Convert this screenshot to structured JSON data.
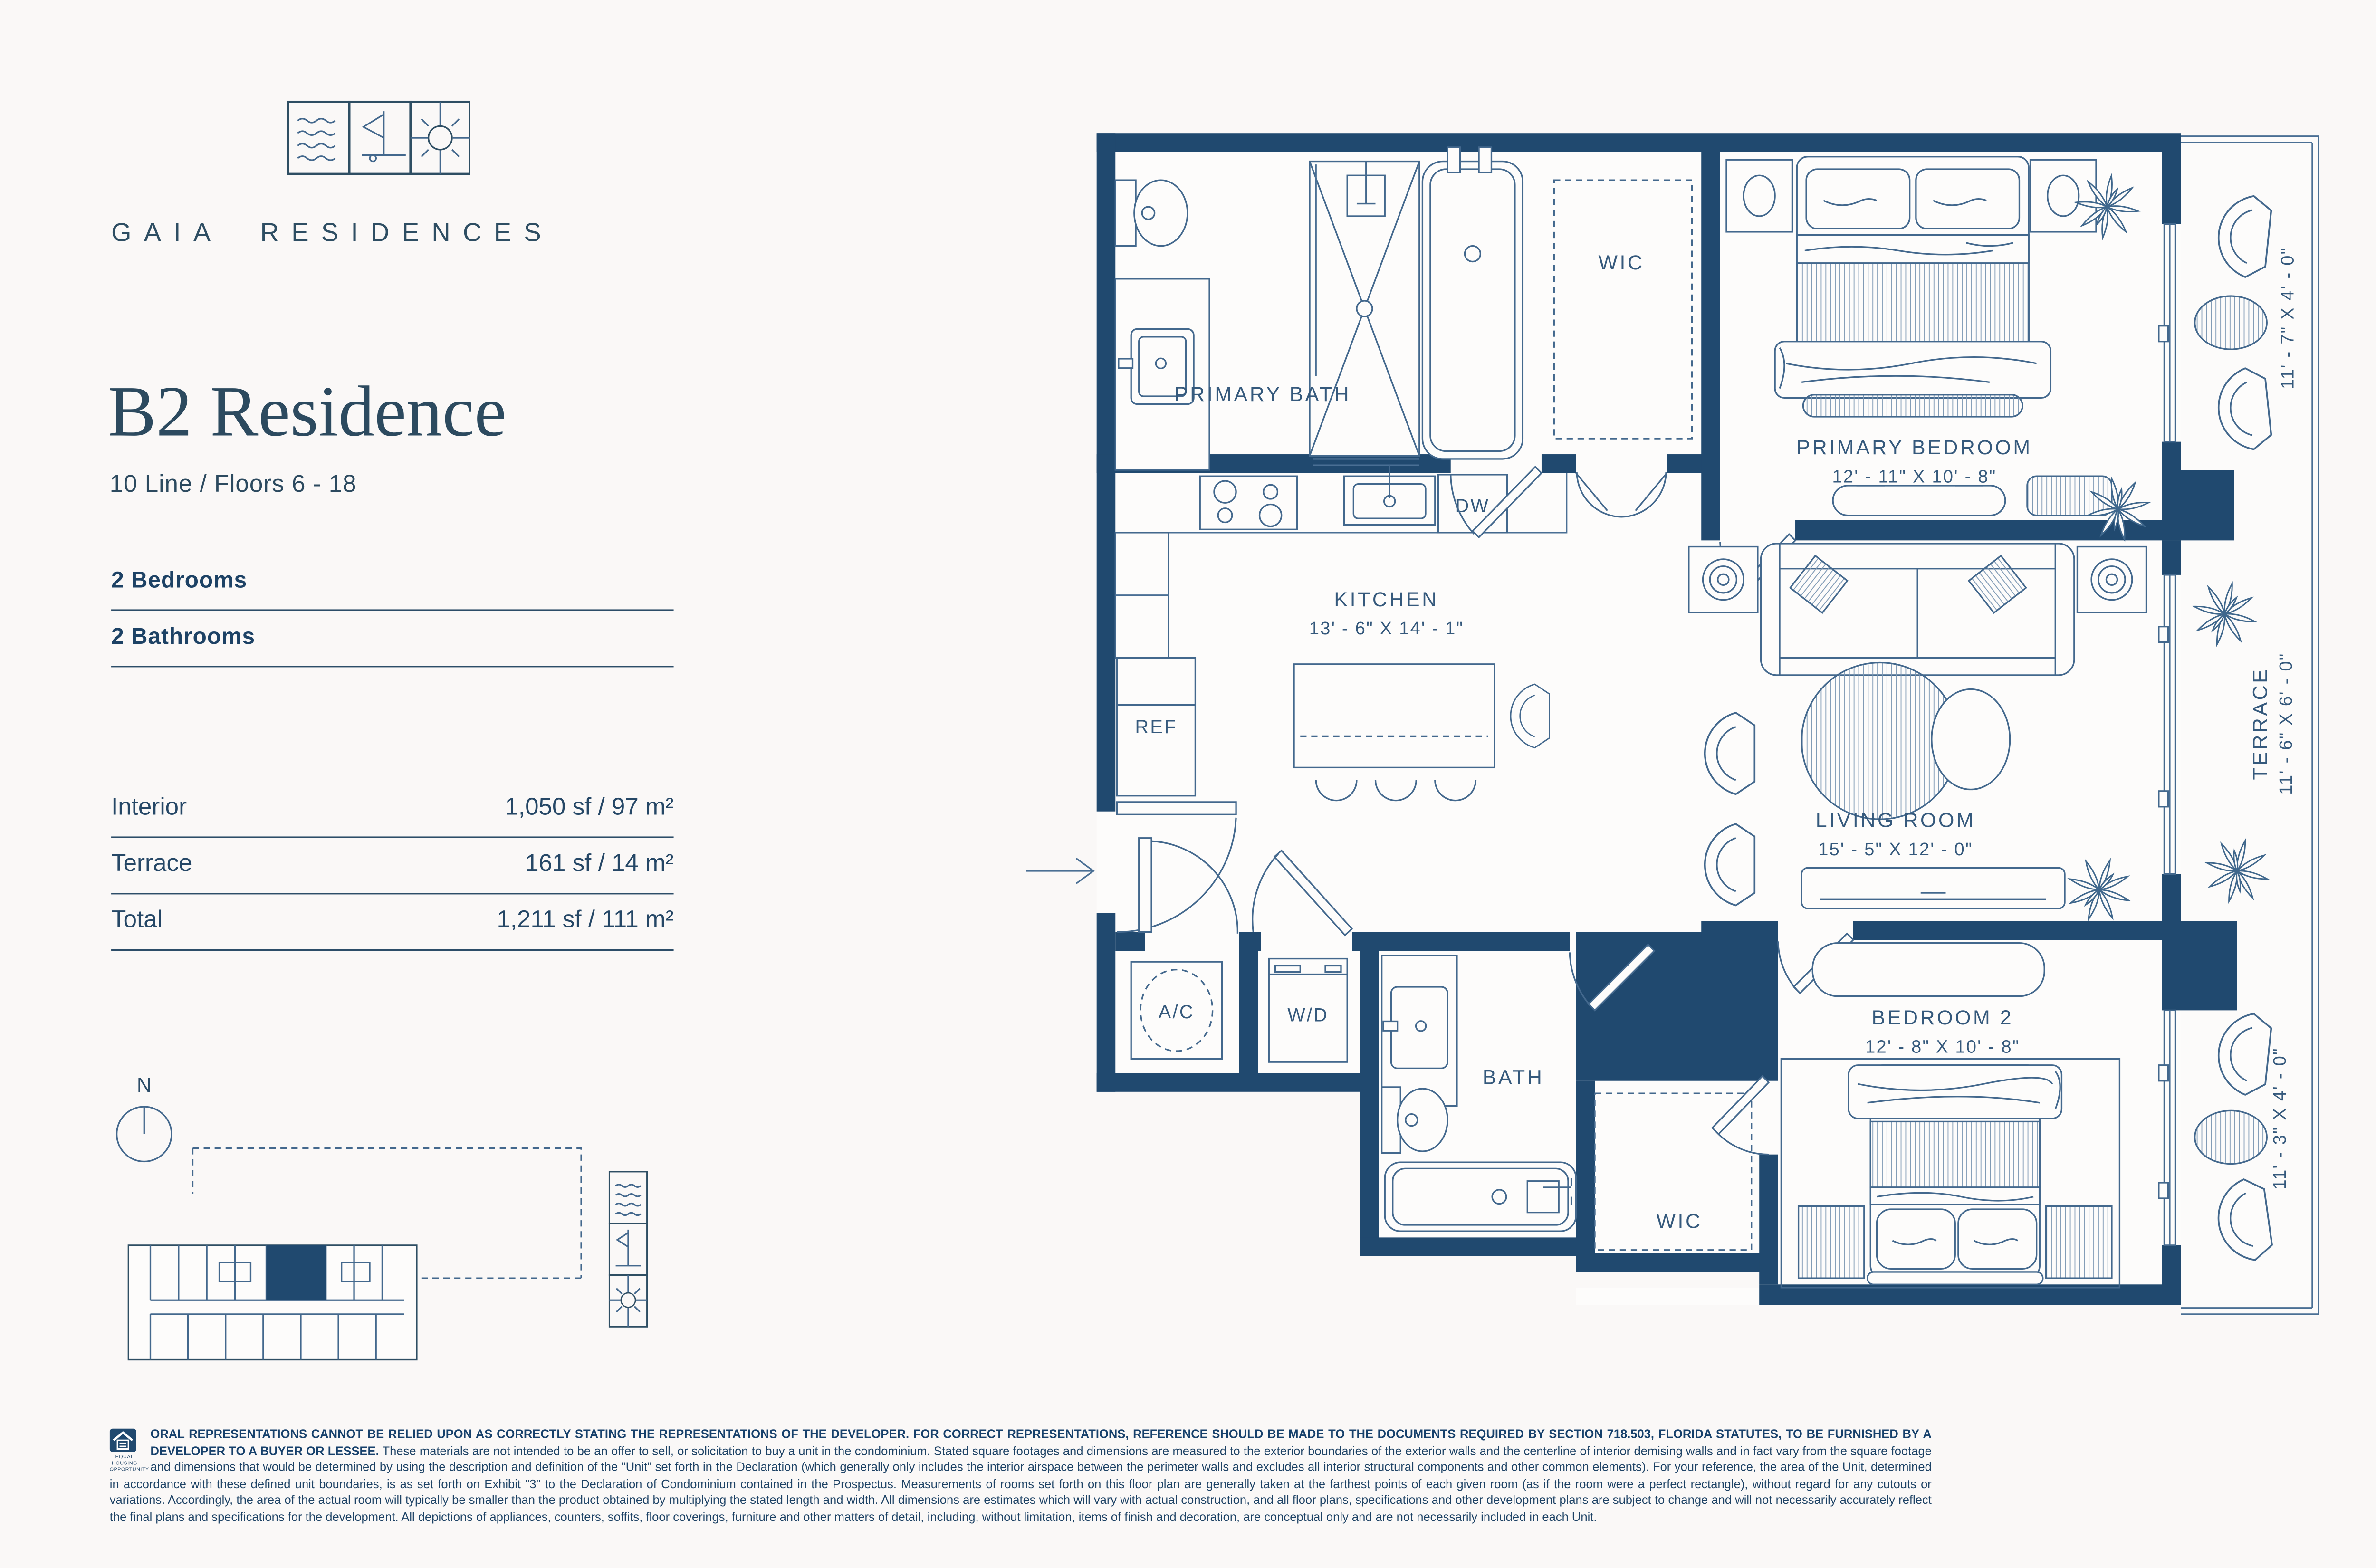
{
  "colors": {
    "wall_navy": "#20496F",
    "ink": "#294A63",
    "line_steel": "#43688D",
    "background": "#FAF8F7"
  },
  "brand": {
    "name": "GAIA RESIDENCES",
    "icons": [
      "waves-icon",
      "sail-icon",
      "sun-icon"
    ]
  },
  "unit": {
    "title": "B2 Residence",
    "subtitle": "10 Line / Floors 6 - 18",
    "features": [
      {
        "label": "2 Bedrooms"
      },
      {
        "label": "2 Bathrooms"
      }
    ]
  },
  "areas": {
    "rows": [
      {
        "label": "Interior",
        "value": "1,050 sf / 97 m²"
      },
      {
        "label": "Terrace",
        "value": "161 sf / 14 m²"
      },
      {
        "label": "Total",
        "value": "1,211 sf / 111 m²"
      }
    ]
  },
  "compass": {
    "north": "N"
  },
  "plan": {
    "primary_bath": "PRIMARY BATH",
    "primary_wic": "WIC",
    "primary_bedroom": "PRIMARY BEDROOM",
    "primary_bedroom_dims": "12' - 11\" X 10' - 8\"",
    "kitchen": "KITCHEN",
    "kitchen_dims": "13' - 6\" X 14' - 1\"",
    "living_room": "LIVING ROOM",
    "living_room_dims": "15' - 5\" X 12' - 0\"",
    "bedroom2": "BEDROOM 2",
    "bedroom2_dims": "12' - 8\" X 10' - 8\"",
    "bath2": "BATH",
    "wic2": "WIC",
    "ac": "A/C",
    "wd": "W/D",
    "ref": "REF",
    "dw": "DW",
    "terrace": "TERRACE",
    "terrace_dims": "11' - 6\" X 6' - 0\"",
    "terrace_upper_dims": "11' - 7\" X 4' - 0\"",
    "terrace_lower_dims": "11' - 3\" X 4' - 0\""
  },
  "disclaimer": {
    "housing_caption": "EQUAL HOUSING OPPORTUNITY",
    "lead": "ORAL REPRESENTATIONS CANNOT BE RELIED UPON AS CORRECTLY STATING THE REPRESENTATIONS OF THE DEVELOPER. FOR CORRECT REPRESENTATIONS, REFERENCE SHOULD BE MADE TO THE DOCUMENTS REQUIRED BY SECTION 718.503, FLORIDA STATUTES, TO BE FURNISHED BY A DEVELOPER TO A BUYER OR LESSEE.",
    "body": "These materials are not intended to be an offer to sell, or solicitation to buy a unit in the condominium. Stated square footages and dimensions are measured to the exterior boundaries of the exterior walls and the centerline of interior demising walls and in fact vary from the square footage and dimensions that would be determined by using the description and definition of the \"Unit\" set forth in the Declaration (which generally only includes the interior airspace between the perimeter walls and excludes all interior structural components and other common elements). For your reference, the area of the Unit, determined in accordance with these defined unit boundaries, is as set forth on Exhibit \"3\" to the Declaration of Condominium contained in the Prospectus. Measurements of rooms set forth on this floor plan are generally taken at the farthest points of each given room (as if the room were a perfect rectangle), without regard for any cutouts or variations. Accordingly, the area of the actual room will typically be smaller than the product obtained by multiplying the stated length and width. All dimensions are estimates which will vary with actual construction, and all floor plans, specifications and other development plans are subject to change and will not necessarily accurately reflect the final plans and specifications for the development. All depictions of appliances, counters, soffits, floor coverings, furniture and other matters of detail, including, without limitation, items of finish and decoration, are conceptual only and are not necessarily included in each Unit."
  }
}
